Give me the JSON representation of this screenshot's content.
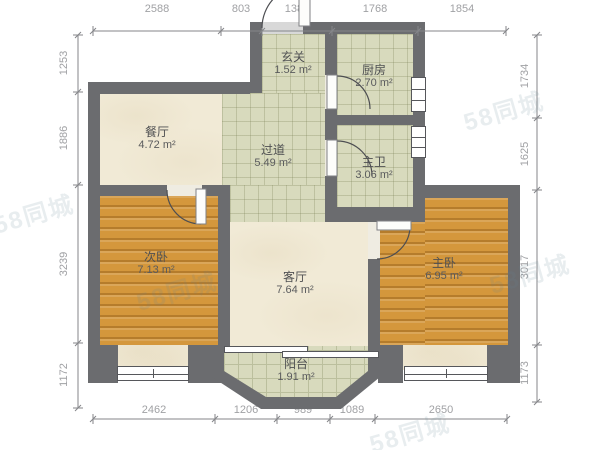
{
  "floor_plan": {
    "rooms": [
      {
        "id": "entry",
        "name": "玄关",
        "area": "1.52 m²"
      },
      {
        "id": "kitchen",
        "name": "厨房",
        "area": "2.70 m²"
      },
      {
        "id": "dining",
        "name": "餐厅",
        "area": "4.72 m²"
      },
      {
        "id": "hallway",
        "name": "过道",
        "area": "5.49 m²"
      },
      {
        "id": "master-bath",
        "name": "主卫",
        "area": "3.06 m²"
      },
      {
        "id": "second-bedroom",
        "name": "次卧",
        "area": "7.13 m²"
      },
      {
        "id": "living-room",
        "name": "客厅",
        "area": "7.64 m²"
      },
      {
        "id": "master-bedroom",
        "name": "主卧",
        "area": "6.95 m²"
      },
      {
        "id": "balcony",
        "name": "阳台",
        "area": "1.91 m²"
      }
    ],
    "dimensions_mm": {
      "top": [
        "2588",
        "803",
        "1388",
        "1768",
        "1854"
      ],
      "bottom": [
        "2462",
        "1206",
        "989",
        "1089",
        "2650"
      ],
      "left": [
        "1253",
        "1886",
        "3239",
        "1172"
      ],
      "right": [
        "1734",
        "1625",
        "3017",
        "1173"
      ]
    },
    "watermark": "58同城",
    "colors": {
      "wall": "#6b6c6f",
      "wood-floor": "#d4973c",
      "tile-floor": "#d8dabd",
      "cream-floor": "#f1ead6",
      "label-text": "#4f5052",
      "dim-text": "#a0a1a4",
      "dim-line": "#85868a"
    }
  }
}
